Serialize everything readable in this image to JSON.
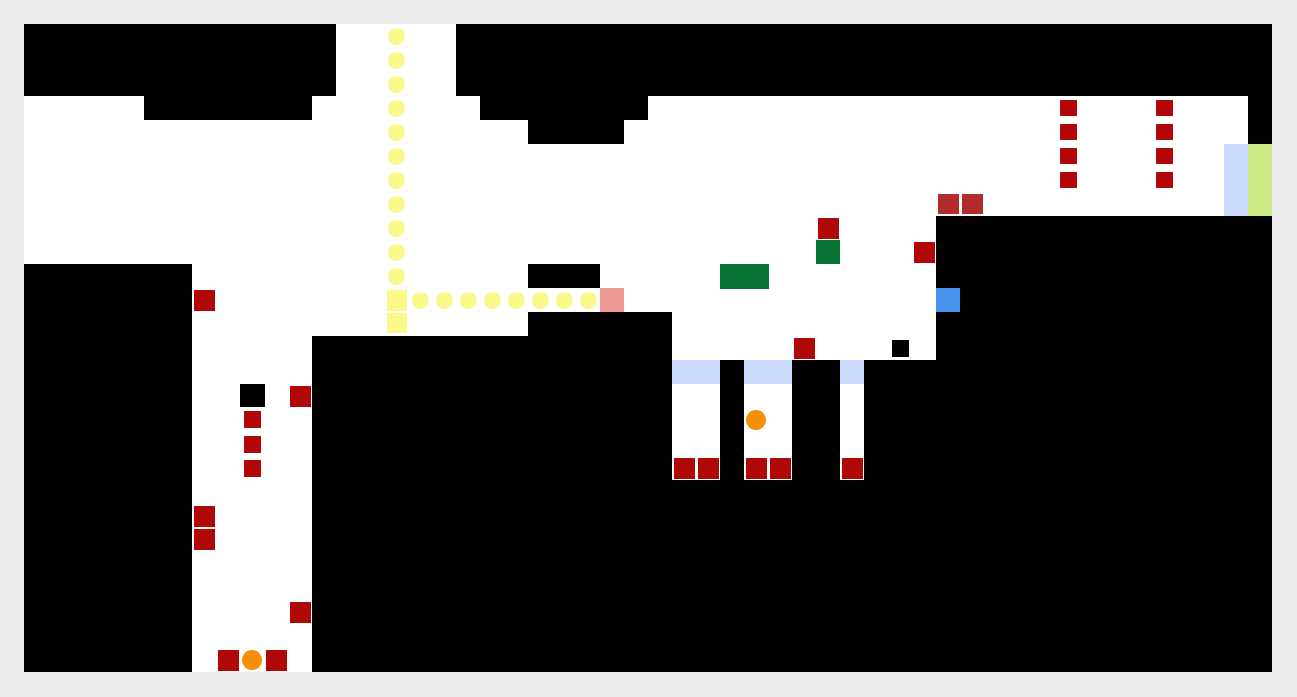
{
  "page": {
    "background": "#ececec",
    "width": 1297,
    "height": 697
  },
  "board": {
    "x": 24,
    "y": 24,
    "width": 1248,
    "height": 648,
    "grid_cell": 24,
    "wall_color": "#000000",
    "floor_color": "#ffffff"
  },
  "palette": {
    "red": "#b00707",
    "brick": "#b22c2c",
    "green": "#077434",
    "blue": "#4694ed",
    "periwinkle": "#c9dafd",
    "chartreuse": "#cde985",
    "yellow": "#fcf98b",
    "salmon": "#ee9894",
    "orange": "#f59004",
    "black": "#000000"
  },
  "floors": [
    [
      336,
      24,
      120,
      72
    ],
    [
      24,
      96,
      120,
      24
    ],
    [
      312,
      96,
      168,
      24
    ],
    [
      648,
      96,
      600,
      24
    ],
    [
      24,
      120,
      504,
      24
    ],
    [
      624,
      120,
      624,
      24
    ],
    [
      24,
      144,
      1200,
      72
    ],
    [
      24,
      216,
      912,
      48
    ],
    [
      192,
      264,
      336,
      24
    ],
    [
      600,
      264,
      336,
      24
    ],
    [
      192,
      288,
      744,
      24
    ],
    [
      192,
      312,
      336,
      24
    ],
    [
      672,
      312,
      264,
      48
    ],
    [
      192,
      336,
      120,
      336
    ],
    [
      672,
      384,
      48,
      96
    ],
    [
      744,
      384,
      48,
      96
    ],
    [
      840,
      384,
      24,
      96
    ]
  ],
  "sprites": [
    {
      "name": "gate-tile",
      "color": "periwinkle",
      "rect": [
        672,
        360,
        48,
        24
      ]
    },
    {
      "name": "gate-tile",
      "color": "periwinkle",
      "rect": [
        744,
        360,
        48,
        24
      ]
    },
    {
      "name": "gate-tile",
      "color": "periwinkle",
      "rect": [
        840,
        360,
        24,
        24
      ]
    },
    {
      "name": "gate-bar",
      "color": "periwinkle",
      "rect": [
        1224,
        144,
        24,
        72
      ]
    },
    {
      "name": "exit-bar",
      "color": "chartreuse",
      "rect": [
        1248,
        144,
        24,
        72
      ]
    },
    {
      "name": "salmon-tile",
      "color": "salmon",
      "rect": [
        600,
        288,
        24,
        24
      ]
    },
    {
      "name": "blue-tile",
      "color": "blue",
      "rect": [
        936,
        288,
        24,
        24
      ]
    },
    {
      "name": "green-block",
      "color": "green",
      "rect": [
        816,
        240,
        24,
        24
      ]
    },
    {
      "name": "green-bar",
      "color": "green",
      "rect": [
        720,
        264,
        49,
        25
      ]
    },
    {
      "name": "yellow-marker",
      "color": "yellow",
      "rect": [
        387,
        290,
        20,
        21
      ]
    },
    {
      "name": "yellow-marker",
      "color": "yellow",
      "rect": [
        387,
        313,
        20,
        20
      ]
    },
    {
      "name": "red-block",
      "color": "red",
      "rect": [
        194,
        290,
        21,
        21
      ]
    },
    {
      "name": "red-block",
      "color": "red",
      "rect": [
        290,
        386,
        21,
        21
      ]
    },
    {
      "name": "red-block",
      "color": "red",
      "rect": [
        194,
        506,
        21,
        21
      ]
    },
    {
      "name": "red-block",
      "color": "red",
      "rect": [
        194,
        529,
        21,
        21
      ]
    },
    {
      "name": "red-block",
      "color": "red",
      "rect": [
        290,
        602,
        21,
        21
      ]
    },
    {
      "name": "red-block",
      "color": "red",
      "rect": [
        218,
        650,
        21,
        21
      ]
    },
    {
      "name": "red-block",
      "color": "red",
      "rect": [
        266,
        650,
        21,
        21
      ]
    },
    {
      "name": "red-block",
      "color": "red",
      "rect": [
        818,
        218,
        21,
        21
      ]
    },
    {
      "name": "red-block",
      "color": "red",
      "rect": [
        914,
        242,
        21,
        21
      ]
    },
    {
      "name": "red-block",
      "color": "red",
      "rect": [
        794,
        338,
        21,
        21
      ]
    },
    {
      "name": "red-block",
      "color": "red",
      "rect": [
        674,
        458,
        21,
        21
      ]
    },
    {
      "name": "red-block",
      "color": "red",
      "rect": [
        698,
        458,
        21,
        21
      ]
    },
    {
      "name": "red-block",
      "color": "red",
      "rect": [
        746,
        458,
        21,
        21
      ]
    },
    {
      "name": "red-block",
      "color": "red",
      "rect": [
        770,
        458,
        21,
        21
      ]
    },
    {
      "name": "red-block",
      "color": "red",
      "rect": [
        842,
        458,
        21,
        21
      ]
    },
    {
      "name": "small-red-block",
      "color": "red",
      "rect": [
        244,
        411,
        17,
        17
      ]
    },
    {
      "name": "small-red-block",
      "color": "red",
      "rect": [
        244,
        436,
        17,
        17
      ]
    },
    {
      "name": "small-red-block",
      "color": "red",
      "rect": [
        244,
        460,
        17,
        17
      ]
    },
    {
      "name": "small-red-block",
      "color": "red",
      "rect": [
        1060,
        100,
        17,
        16
      ]
    },
    {
      "name": "small-red-block",
      "color": "red",
      "rect": [
        1060,
        124,
        17,
        16
      ]
    },
    {
      "name": "small-red-block",
      "color": "red",
      "rect": [
        1060,
        148,
        17,
        16
      ]
    },
    {
      "name": "small-red-block",
      "color": "red",
      "rect": [
        1060,
        172,
        17,
        16
      ]
    },
    {
      "name": "small-red-block",
      "color": "red",
      "rect": [
        1156,
        100,
        17,
        16
      ]
    },
    {
      "name": "small-red-block",
      "color": "red",
      "rect": [
        1156,
        124,
        17,
        16
      ]
    },
    {
      "name": "small-red-block",
      "color": "red",
      "rect": [
        1156,
        148,
        17,
        16
      ]
    },
    {
      "name": "small-red-block",
      "color": "red",
      "rect": [
        1156,
        172,
        17,
        16
      ]
    },
    {
      "name": "brick-block",
      "color": "brick",
      "rect": [
        938,
        194,
        21,
        20
      ]
    },
    {
      "name": "brick-block",
      "color": "brick",
      "rect": [
        962,
        194,
        21,
        20
      ]
    },
    {
      "name": "black-block",
      "color": "black",
      "rect": [
        240,
        384,
        25,
        23
      ]
    },
    {
      "name": "black-block",
      "color": "black",
      "rect": [
        892,
        340,
        17,
        17
      ]
    }
  ],
  "trail_dots": {
    "color": "yellow",
    "diameter": 17,
    "centers": [
      [
        396,
        36
      ],
      [
        396,
        60
      ],
      [
        396,
        84
      ],
      [
        396,
        108
      ],
      [
        396,
        132
      ],
      [
        396,
        156
      ],
      [
        396,
        180
      ],
      [
        396,
        204
      ],
      [
        396,
        228
      ],
      [
        396,
        252
      ],
      [
        396,
        276
      ],
      [
        420,
        300
      ],
      [
        444,
        300
      ],
      [
        468,
        300
      ],
      [
        492,
        300
      ],
      [
        516,
        300
      ],
      [
        540,
        300
      ],
      [
        564,
        300
      ],
      [
        588,
        300
      ]
    ]
  },
  "balls": {
    "color": "orange",
    "diameter": 20,
    "centers": [
      [
        756,
        420
      ],
      [
        252,
        660
      ]
    ]
  }
}
